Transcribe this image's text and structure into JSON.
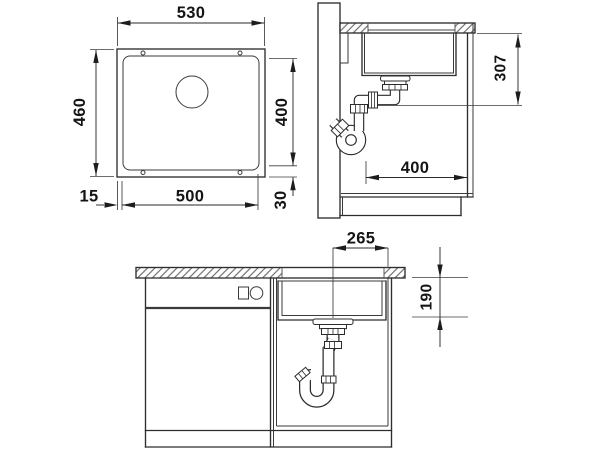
{
  "document": {
    "type": "technical-dimension-drawing",
    "subject": "undermount kitchen sink installation drawing with plan view, side section and front section"
  },
  "colors": {
    "background": "#ffffff",
    "ink": "#2e2e2e",
    "dimension_text": "#141414"
  },
  "views": {
    "plan": "sink-top-view",
    "side": "cabinet-side-section",
    "front": "cabinet-front-section"
  },
  "dims": {
    "plan_outer_width": "530",
    "plan_outer_depth": "460",
    "plan_cutout_width": "500",
    "plan_cutout_depth": "400",
    "plan_side_offset": "15",
    "plan_front_offset": "30",
    "side_drain_height": "307",
    "side_drain_setback": "400",
    "front_drain_offset": "265",
    "front_bowl_depth": "190"
  }
}
